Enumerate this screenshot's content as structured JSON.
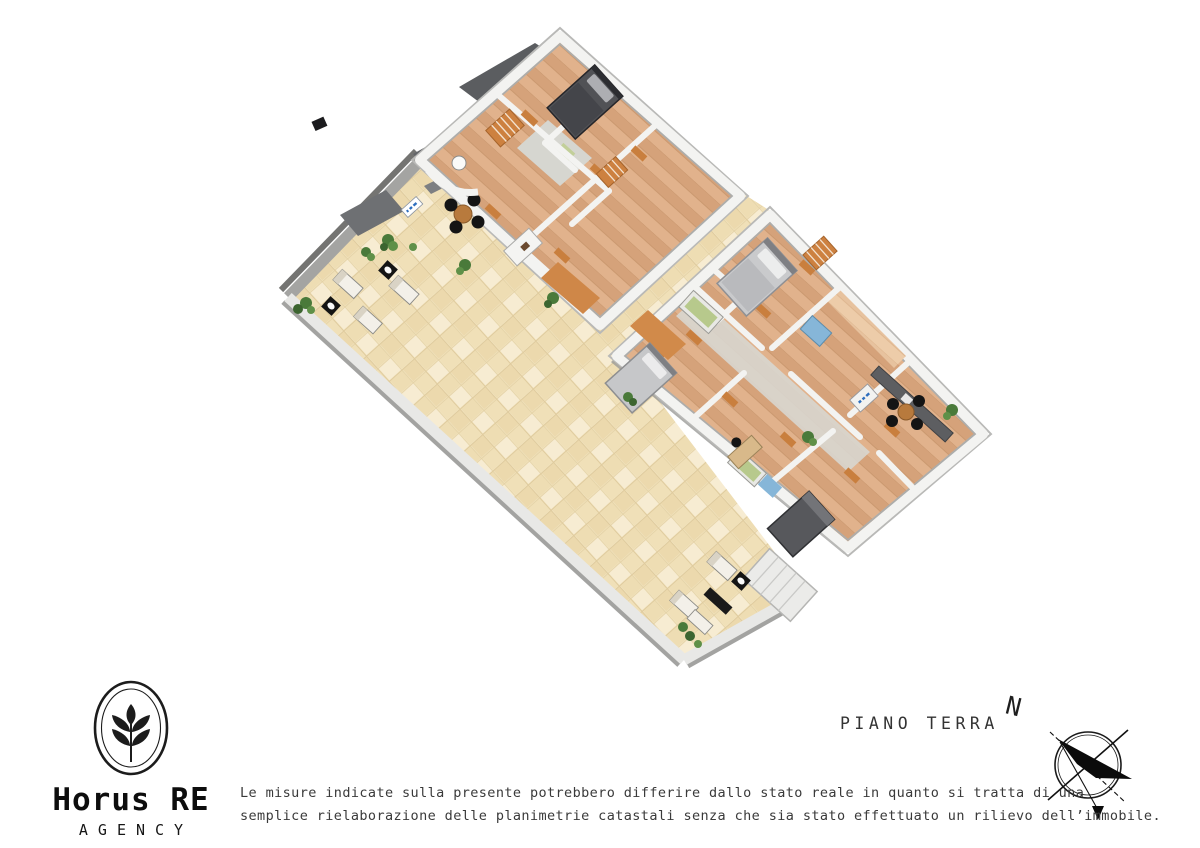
{
  "plan": {
    "label": "PIANO TERRA",
    "compass_north_label": "N"
  },
  "branding": {
    "name": "Horus RE",
    "subtitle": "AGENCY"
  },
  "disclaimer": {
    "line1": "Le misure indicate sulla presente potrebbero differire dallo stato reale in quanto si tratta di una",
    "line2": "semplice rielaborazione delle planimetrie catastali senza che sia stato effettuato un rilievo dell’immobile."
  },
  "colors": {
    "terrace_tile": "#f2e4c0",
    "wood_floor": "#dcab85",
    "accent_orange": "#cd8347",
    "wall_white": "#f3f3f1",
    "parapet_gray": "#9f9f9d",
    "roof_gray": "#5b5d60",
    "bath_green": "#b7c98c",
    "bath_blue": "#86b6d8",
    "text": "#3a3a3a"
  }
}
